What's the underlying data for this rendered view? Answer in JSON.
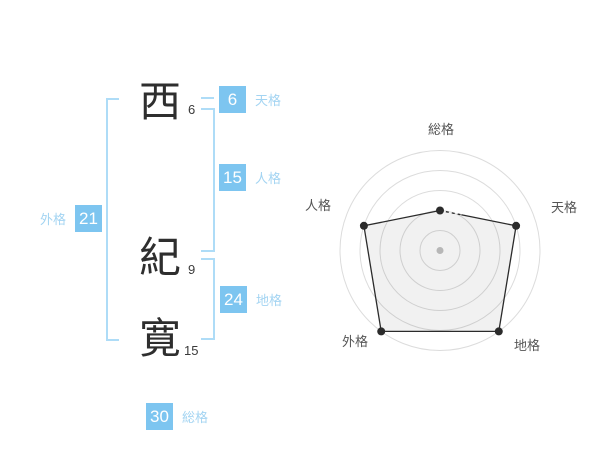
{
  "name_panel": {
    "characters": [
      {
        "char": "西",
        "strokes": "6"
      },
      {
        "char": "紀",
        "strokes": "9"
      },
      {
        "char": "寛",
        "strokes": "15"
      }
    ],
    "kaku": [
      {
        "id": "tenkaku",
        "label": "天格",
        "value": "6"
      },
      {
        "id": "jinkaku",
        "label": "人格",
        "value": "15"
      },
      {
        "id": "chikaku",
        "label": "地格",
        "value": "24"
      },
      {
        "id": "gaikaku",
        "label": "外格",
        "value": "21"
      },
      {
        "id": "soukaku",
        "label": "総格",
        "value": "30"
      }
    ]
  },
  "colors": {
    "badge_blue": "#7dc5f0",
    "label_blue": "#a3d4f2",
    "bracket_blue": "#aedcf7",
    "text_dark": "#2e2e2e"
  },
  "chart_data": {
    "type": "radar",
    "title": "",
    "categories": [
      "総格",
      "天格",
      "地格",
      "外格",
      "人格"
    ],
    "values": [
      2,
      4,
      5,
      5,
      4
    ],
    "scale_max": 5,
    "ring_count": 5,
    "ring_step": 1,
    "start_angle_deg": 90,
    "direction": "clockwise",
    "grid_shape": "concentric-circles",
    "legend": false,
    "grid_color": "#dcdcdc",
    "line_color": "#2b2b2b",
    "fill_color": "rgba(0,0,0,0.055)",
    "point_color": "#2b2b2b",
    "center_dot_color": "#c2c2c2",
    "label_color": "#555555"
  }
}
